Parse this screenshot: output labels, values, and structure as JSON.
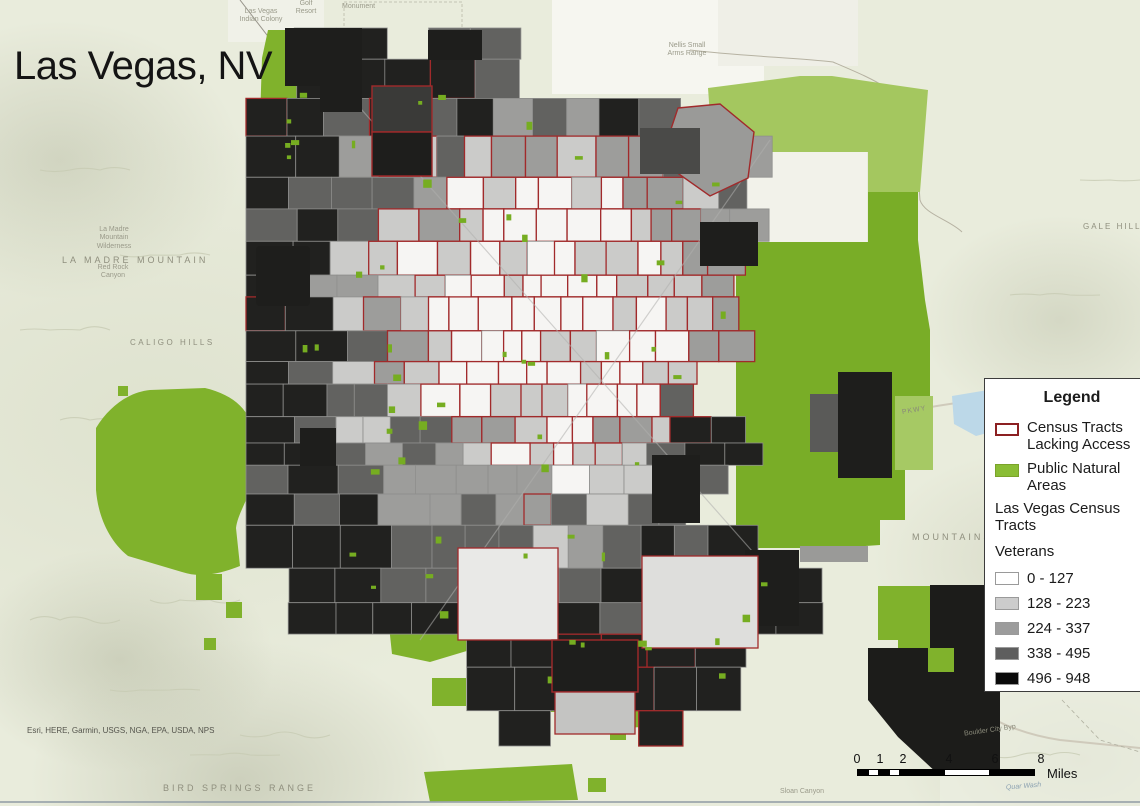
{
  "title": "Las Vegas, NV",
  "attribution": "Esri, HERE, Garmin, USGS, NGA, EPA, USDA, NPS",
  "legend": {
    "title": "Legend",
    "items": [
      {
        "label": "Census Tracts Lacking Access",
        "swatch": "outline-red"
      },
      {
        "label": "Public Natural Areas",
        "swatch": "green-fill"
      }
    ],
    "layer_title": "Las Vegas Census Tracts",
    "field_title": "Veterans",
    "classes": [
      {
        "label": "0 - 127",
        "color": "#ffffff"
      },
      {
        "label": "128 - 223",
        "color": "#cccccc"
      },
      {
        "label": "224 - 337",
        "color": "#9c9c9c"
      },
      {
        "label": "338 - 495",
        "color": "#5e5e5e"
      },
      {
        "label": "496 - 948",
        "color": "#0a0a0a"
      }
    ]
  },
  "scale_bar": {
    "ticks": [
      "0",
      "1",
      "2",
      "4",
      "6",
      "8"
    ],
    "unit": "Miles"
  },
  "map_labels": {
    "la_madre_mountain": "LA MADRE MOUNTAIN",
    "la_madre_wilderness": "La Madre Mountain Wilderness",
    "red_rock_canyon": "Red Rock Canyon",
    "caligo_hills": "CALIGO HILLS",
    "gale_hills": "GALE HILLS",
    "bird_springs_range": "BIRD SPRINGS RANGE",
    "mountains": "MOUNTAINS",
    "nellis_small_arms_range": "Nellis Small Arms Range",
    "las_vegas_indian_colony": "Las Vegas Indian Colony",
    "golf_resort": "Golf Resort",
    "monument": "Monument",
    "sloan_canyon": "Sloan Canyon",
    "boulder_city_byp": "Boulder City Byp",
    "quar_wash": "Quar Wash",
    "pkwy": "PKWY"
  },
  "colors": {
    "natural_green": "#80b22c",
    "natural_green_light": "#a6c964",
    "legend_green": "#8abd35",
    "lacking_access_outline": "#a12a2b",
    "basemap": "#e9ecdc"
  }
}
